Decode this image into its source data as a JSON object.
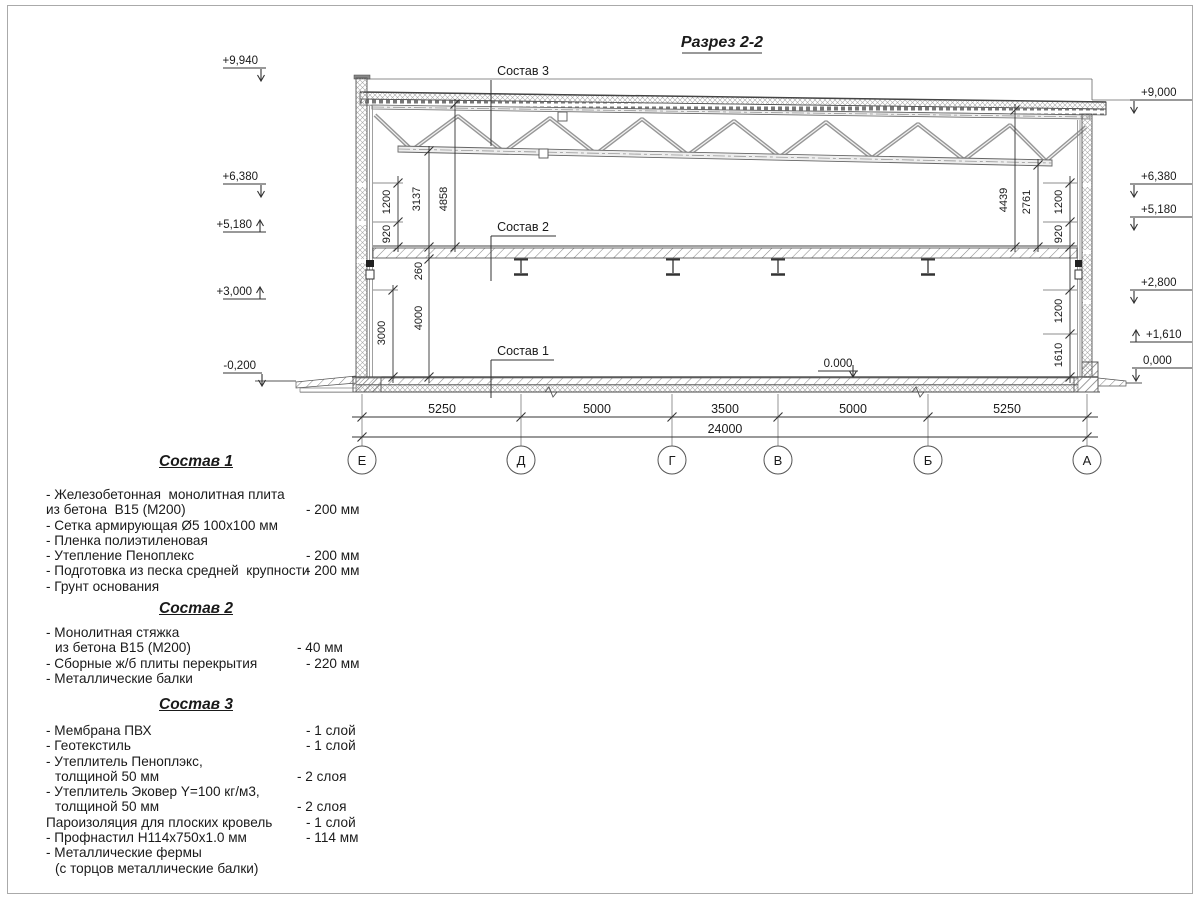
{
  "title": "Разрез 2-2",
  "drawing": {
    "callouts": [
      "Состав 1",
      "Состав 2",
      "Состав 3"
    ],
    "elev_left": [
      "+9,940",
      "+6,380",
      "+5,180",
      "+3,000",
      "-0,200"
    ],
    "elev_right": [
      "+9,000",
      "+6,380",
      "+5,180",
      "+2,800",
      "+1,610",
      "0,000"
    ],
    "zero_mark": "0.000",
    "dims": {
      "wall_left": [
        "1200",
        "920"
      ],
      "truss_to_floor": "3137",
      "roof_to_floor": "4858",
      "slab": "260",
      "storey": "4000",
      "plinth_left": "3000",
      "right_truss": "4439",
      "right_truss2": "2761",
      "wall_right_upper": [
        "1200",
        "920"
      ],
      "wall_right_lower": [
        "1200",
        "1610"
      ],
      "spans": [
        "5250",
        "5000",
        "3500",
        "5000",
        "5250"
      ],
      "total": "24000"
    },
    "axes": [
      "Е",
      "Д",
      "Г",
      "В",
      "Б",
      "А"
    ]
  },
  "legend": {
    "sections": [
      {
        "heading": "Состав 1",
        "rows": [
          {
            "t": "- Железобетонная  монолитная плита",
            "v": ""
          },
          {
            "t": "из бетона  В15 (М200)",
            "v": "- 200 мм"
          },
          {
            "t": "- Сетка армирующая Ø5 100х100 мм",
            "v": ""
          },
          {
            "t": "- Пленка полиэтиленовая",
            "v": ""
          },
          {
            "t": "- Утепление Пеноплекс",
            "v": "- 200 мм"
          },
          {
            "t": "- Подготовка из песка средней  крупности",
            "v": "- 200 мм"
          },
          {
            "t": "- Грунт основания",
            "v": ""
          }
        ]
      },
      {
        "heading": "Состав 2",
        "rows": [
          {
            "t": "- Монолитная стяжка",
            "v": ""
          },
          {
            "t": "из бетона В15 (М200)",
            "v": "- 40 мм"
          },
          {
            "t": "- Сборные ж/б плиты перекрытия",
            "v": "- 220 мм"
          },
          {
            "t": "- Металлические балки",
            "v": ""
          }
        ]
      },
      {
        "heading": "Состав 3",
        "rows": [
          {
            "t": "- Мембрана ПВХ",
            "v": "- 1 слой"
          },
          {
            "t": "- Геотекстиль",
            "v": "- 1 слой"
          },
          {
            "t": "- Утеплитель Пеноплэкс,",
            "v": ""
          },
          {
            "t": "толщиной 50 мм",
            "v": "- 2 слоя"
          },
          {
            "t": "- Утеплитель Эковер Y=100 кг/м3,",
            "v": ""
          },
          {
            "t": "толщиной 50 мм",
            "v": "- 2 слоя"
          },
          {
            "t": "Пароизоляция для плоских кровель",
            "v": "- 1 слой"
          },
          {
            "t": "- Профнастил Н114х750х1.0 мм",
            "v": "- 114 мм"
          },
          {
            "t": "- Металлические фермы",
            "v": ""
          },
          {
            "t": "(с торцов металлические балки)",
            "v": ""
          }
        ]
      }
    ]
  }
}
